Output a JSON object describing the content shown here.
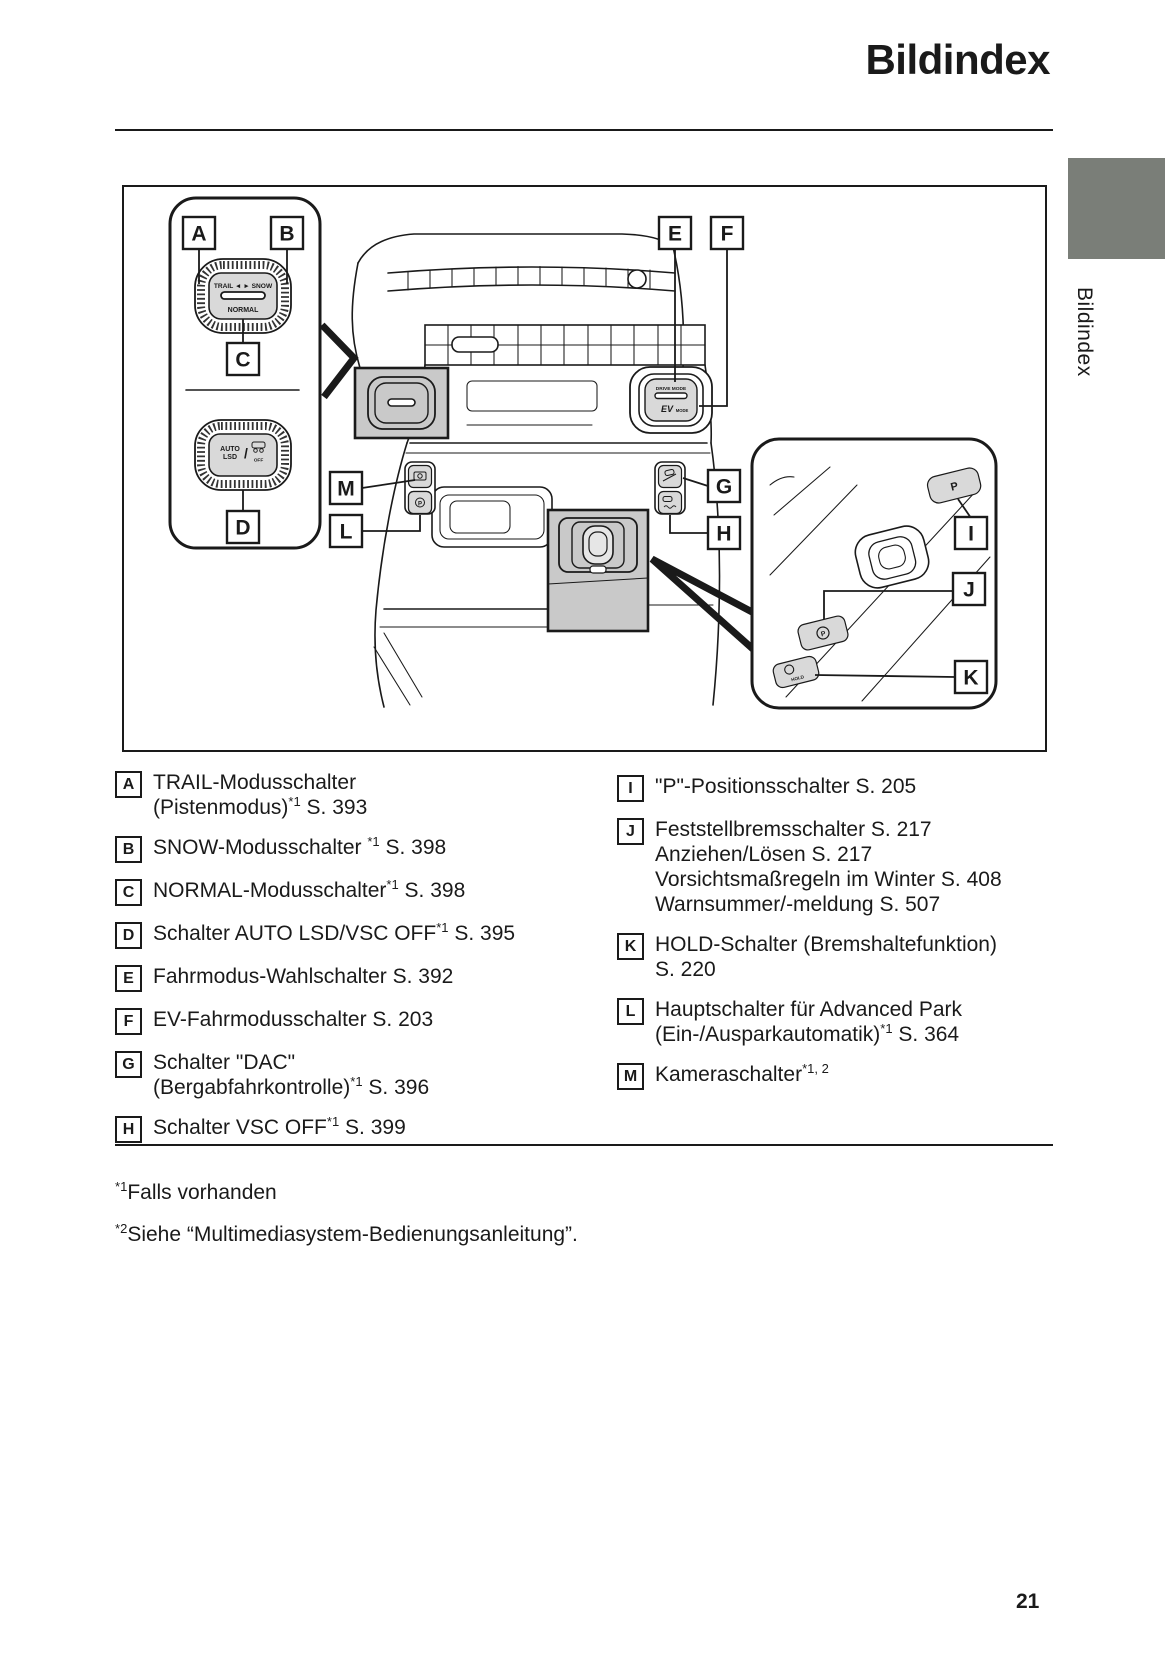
{
  "page": {
    "title": "Bildindex",
    "side_tab": "Bildindex",
    "page_number": "21"
  },
  "colors": {
    "tab_gray": "#7a7e78",
    "highlight_gray": "#c9c9c9",
    "button_gray": "#d9d9d9",
    "text": "#1a1a1a"
  },
  "diagram": {
    "callouts": [
      "A",
      "B",
      "C",
      "D",
      "E",
      "F",
      "G",
      "H",
      "I",
      "J",
      "K",
      "L",
      "M"
    ],
    "switches": {
      "trail_snow": "TRAIL ◄  ► SNOW",
      "normal": "NORMAL",
      "auto": "AUTO",
      "lsd": "LSD",
      "lsd_slash": "/",
      "off": "OFF",
      "drive_mode": "DRIVE MODE",
      "ev": "EV",
      "mode": "MODE",
      "p": "P",
      "park_p": "P",
      "ap_p": "P",
      "hold": "HOLD"
    }
  },
  "legend": {
    "left": [
      {
        "letter": "A",
        "lines": [
          [
            {
              "t": "TRAIL-Modusschalter"
            }
          ],
          [
            {
              "t": "(Pistenmodus)"
            },
            {
              "sup": "*1"
            },
            {
              "t": " S. 393"
            }
          ]
        ]
      },
      {
        "letter": "B",
        "lines": [
          [
            {
              "t": "SNOW-Modusschalter "
            },
            {
              "sup": "*1"
            },
            {
              "t": " S. 398"
            }
          ]
        ]
      },
      {
        "letter": "C",
        "lines": [
          [
            {
              "t": "NORMAL-Modusschalter"
            },
            {
              "sup": "*1"
            },
            {
              "t": " S. 398"
            }
          ]
        ]
      },
      {
        "letter": "D",
        "lines": [
          [
            {
              "t": "Schalter AUTO LSD/VSC OFF"
            },
            {
              "sup": "*1"
            },
            {
              "t": " S. 395"
            }
          ]
        ]
      },
      {
        "letter": "E",
        "lines": [
          [
            {
              "t": "Fahrmodus-Wahlschalter S. 392"
            }
          ]
        ]
      },
      {
        "letter": "F",
        "lines": [
          [
            {
              "t": "EV-Fahrmodusschalter S. 203"
            }
          ]
        ]
      },
      {
        "letter": "G",
        "lines": [
          [
            {
              "t": "Schalter \"DAC\""
            }
          ],
          [
            {
              "t": "(Bergabfahrkontrolle)"
            },
            {
              "sup": "*1"
            },
            {
              "t": " S. 396"
            }
          ]
        ]
      },
      {
        "letter": "H",
        "lines": [
          [
            {
              "t": "Schalter VSC OFF"
            },
            {
              "sup": "*1"
            },
            {
              "t": " S. 399"
            }
          ]
        ]
      }
    ],
    "right": [
      {
        "letter": "I",
        "lines": [
          [
            {
              "t": "\"P\"-Positionsschalter S. 205"
            }
          ]
        ]
      },
      {
        "letter": "J",
        "lines": [
          [
            {
              "t": "Feststellbremsschalter S. 217"
            }
          ],
          [
            {
              "t": "Anziehen/Lösen S. 217"
            }
          ],
          [
            {
              "t": "Vorsichtsmaßregeln im Winter S. 408"
            }
          ],
          [
            {
              "t": "Warnsummer/-meldung S. 507"
            }
          ]
        ]
      },
      {
        "letter": "K",
        "lines": [
          [
            {
              "t": "HOLD-Schalter (Bremshaltefunktion)"
            }
          ],
          [
            {
              "t": "S. 220"
            }
          ]
        ]
      },
      {
        "letter": "L",
        "lines": [
          [
            {
              "t": "Hauptschalter für Advanced Park"
            }
          ],
          [
            {
              "t": "(Ein-/Ausparkautomatik)"
            },
            {
              "sup": "*1"
            },
            {
              "t": " S. 364"
            }
          ]
        ]
      },
      {
        "letter": "M",
        "lines": [
          [
            {
              "t": "Kameraschalter"
            },
            {
              "sup": "*1, 2"
            }
          ]
        ]
      }
    ]
  },
  "footnotes": [
    {
      "sup": "*1",
      "text": "Falls vorhanden"
    },
    {
      "sup": "*2",
      "text": "Siehe “Multimediasystem-Bedienungsanleitung”."
    }
  ]
}
